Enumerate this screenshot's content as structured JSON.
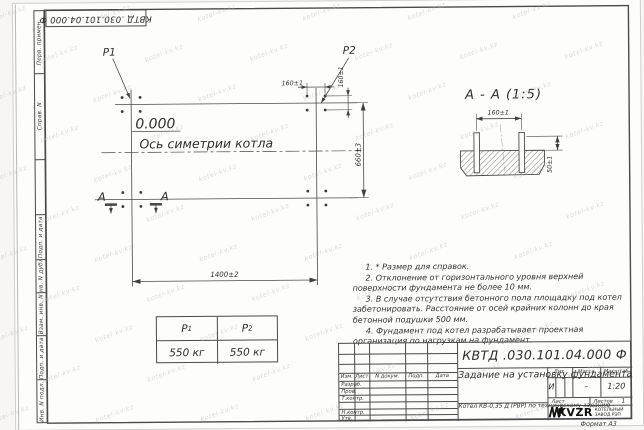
{
  "sheet": {
    "doc_number": "КВТД .030.101.04.000 Ф",
    "format_label": "Формат А3",
    "stamp_fields": [
      "Перв. примен.",
      "Справ. N",
      "",
      "Подп. и дата",
      "Инв. N дубл.",
      "Взам. инв. N",
      "Подп. и дата",
      "Инв. N подл."
    ]
  },
  "plan": {
    "p1_label": "P1",
    "p2_label": "P2",
    "level_mark": "0.000",
    "axis_label": "Ось симетрии котла",
    "dim_length": "1400±2",
    "dim_width": "660±3",
    "dim_bolt_spacing_x": "160±1",
    "dim_bolt_spacing_y": "160±1",
    "section_letter_left": "А",
    "section_letter_right": "А"
  },
  "section_view": {
    "title": "А - А (1:5)",
    "dim_bolt_spacing": "160±1",
    "dim_bolt_height": "50±1"
  },
  "load_table": {
    "columns": [
      {
        "main": "P",
        "sub": "1"
      },
      {
        "main": "P",
        "sub": "2"
      }
    ],
    "values": [
      "550 кг",
      "550 кг"
    ]
  },
  "notes": [
    "1. * Размер для справок.",
    "2. Отклонение от горизонтального уровня верхней поверхности фундамента не более 10 мм.",
    "3. В случае отсутствия бетонного пола площадку под котел забетонировать. Расстояние от осей крайних колонн до края бетонной подушки 500 мм.",
    "4. Фундамент под котел разрабатывает проектная организация по нагрузкам на фундамент."
  ],
  "title_block": {
    "doc_number": "КВТД .030.101.04.000 Ф",
    "title": "Задание на установку фундамента",
    "product": "Котел КВ-0,35 Д (РВР) по техническому заданию",
    "col_izm": "Изм.",
    "col_list": "Лист",
    "col_doc": "N докум.",
    "col_podp": "Подп.",
    "col_data": "Дата",
    "row_razrab": "Разраб.",
    "row_prov": "Пров.",
    "row_tkontr": "Т.контр.",
    "row_nkontr": "Н.контр.",
    "row_utv": "Утв.",
    "lit_label": "Лит.",
    "mass_label": "Масса",
    "scale_label": "Масштаб",
    "lit_value": "И",
    "mass_value": "–",
    "scale_value": "1:20",
    "sheet_label": "Лист",
    "sheets_label": "Листов",
    "sheets_value": "1",
    "logo_text": "KVZR",
    "logo_sub1": "КОТЕЛЬНЫЙ",
    "logo_sub2": "ЗАВОД РЭП"
  },
  "watermark": {
    "text": "kotel-kv.kz"
  }
}
